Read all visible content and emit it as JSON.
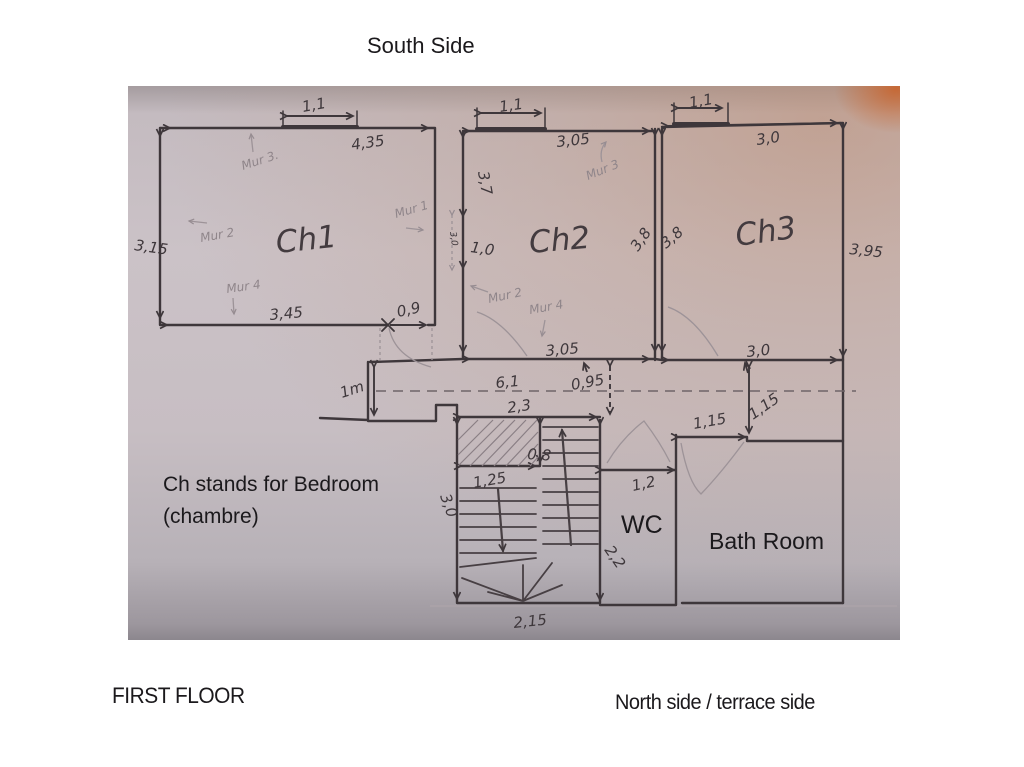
{
  "header": {
    "south_side": "South Side"
  },
  "footer": {
    "first_floor": "FIRST FLOOR",
    "north_side": "North side / terrace side"
  },
  "legend": {
    "line1": "Ch stands for Bedroom",
    "line2": "(chambre)"
  },
  "rooms": {
    "ch1": "Ch1",
    "ch2": "Ch2",
    "ch3": "Ch3",
    "wc": "WC",
    "bath": "Bath Room"
  },
  "dims": {
    "ch1_window": "1,1",
    "ch1_top": "4,35",
    "ch1_left": "3,15",
    "ch1_bottom": "3,45",
    "ch1_door": "0,9",
    "ch2_window": "1,1",
    "ch2_top": "3,05",
    "ch2_wall": "3,7",
    "ch2_seg": "1,0",
    "ch2_dashed": "3,0",
    "ch2_right": "3,8",
    "ch3_left": "3,8",
    "ch2_bottom": "3,05",
    "ch3_window": "1,1",
    "ch3_top": "3,0",
    "ch3_right": "3,95",
    "ch3_bottom": "3,0",
    "corridor_len": "6,1",
    "corridor_w": "0,95",
    "corridor_w_left": "1m",
    "stairs_top": "2,3",
    "flight_w": "0,8",
    "stairs_lw": "1,25",
    "stairs_lh": "3,0",
    "stairs_rh": "2,2",
    "stairs_bottom": "2,15",
    "wc_w": "1,2",
    "bath_top": "1,15",
    "bath_side": "1,15"
  },
  "murs": {
    "ch1_m3": "Mur 3.",
    "ch1_m2": "Mur 2",
    "ch1_m4": "Mur 4",
    "ch1_m1": "Mur 1",
    "ch2_m3": "Mur 3",
    "ch2_m2": "Mur 2",
    "ch2_m4": "Mur 4"
  },
  "colors": {
    "ink": "#3e373b",
    "pencil": "#968c91",
    "paper": "#cac1c6",
    "paper_warm": "#bca093"
  }
}
